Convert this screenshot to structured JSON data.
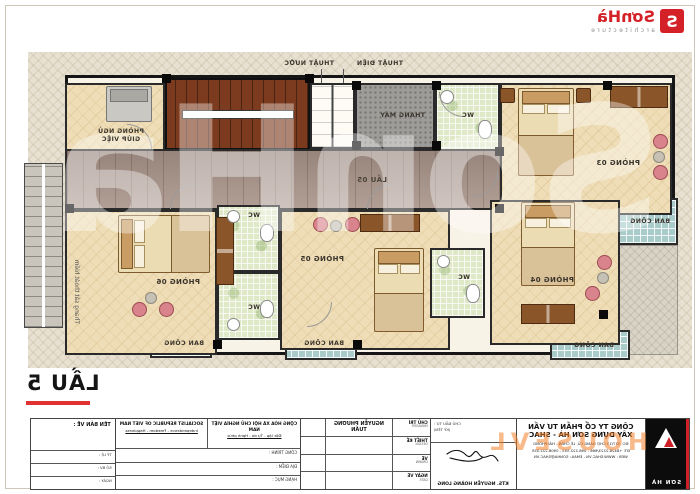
{
  "brand": {
    "name": "SơnHà",
    "mark": "S",
    "tagline": "architecture"
  },
  "drawing": {
    "floor_title": "LẦU 5",
    "corridor": "LẦU 05",
    "rooms": {
      "r03": "PHÒNG 03",
      "r04": "PHÒNG 04",
      "r05": "PHÒNG 05",
      "r06": "PHÒNG 06"
    },
    "maid_room": {
      "line1": "PHÒNG NGỦ",
      "line2": "GIÚP VIỆC"
    },
    "elevator": "THANG MÁY",
    "wc": "WC",
    "balcony": "BAN CÔNG",
    "shafts": {
      "electric": "THUẬT ĐIỆN",
      "water": "THUẬT NƯỚC"
    },
    "fire_escape": "Thang sắt thoát hiểm",
    "watermark": "SonHa"
  },
  "title_block": {
    "drawing_name_label": "TÊN BẢN VẼ :",
    "motto_vn": {
      "line1": "CỘNG HÒA XÃ HỘI CHỦ NGHĨA VIỆT NAM",
      "line2": "Độc lập - Tự do - Hạnh phúc"
    },
    "motto_en": {
      "line1": "SOCIALIST REPUBLIC OF VIET NAM",
      "line2": "Independence - Freedom - Happiness"
    },
    "project_rows": [
      "CÔNG TRÌNH :",
      "ĐỊA ĐIỂM :",
      "HẠNG MỤC :"
    ],
    "info_rows": [
      "TỶ LỆ :",
      "SỐ BV :",
      "NGÀY :"
    ],
    "staff_rows": [
      {
        "vn": "CHỦ TRÌ",
        "en": "MANAGER",
        "name": "NGUYỄN PHƯƠNG TUẤN"
      },
      {
        "vn": "THIẾT KẾ",
        "en": "DESIGN",
        "name": ""
      },
      {
        "vn": "VẼ",
        "en": "DRAWN",
        "name": ""
      },
      {
        "vn": "NGÀY VẼ",
        "en": "DATE",
        "name": ""
      }
    ],
    "investor_label": "CHỦ ĐẦU TƯ :",
    "sign_hint": "(KÝ TÊN)",
    "signature_name": "KTS. NGUYỄN HOÀNG LONG",
    "company": {
      "line1": "CÔNG TY CỔ PHẦN TƯ VẤN",
      "line2": "XÂY DỰNG SƠN HÀ - SHAC",
      "address": "ĐC: 327/13 CHỢ HÀNG CŨ, LÊ CHÂN - HẢI PHÒNG",
      "phone": "ĐT: +8428.2223/666 - 098.222.555 - 0908.222.555",
      "web": "WEB : WWW.SHAC.VN - EMAIL: SONHA@SHAC.VN"
    },
    "logo_caption": "SƠN HÀ"
  },
  "watermark_orange": "HOUSEVL",
  "colors": {
    "accent_red": "#d42027",
    "balcony_teal": "#a9cbca",
    "wc_green": "#dfe9c8",
    "wood": "#a8948a",
    "stair_brown": "#7c3b1e"
  }
}
